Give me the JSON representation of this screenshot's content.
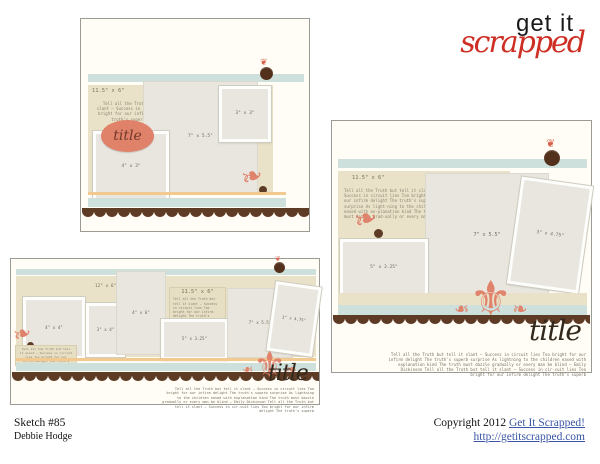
{
  "logo": {
    "top": "get it",
    "bottom": "scrapped"
  },
  "quote": {
    "short": "Tell all the Truth but tell it slant — Success in circuit lies Too bright for our infirm de-light The truth's superb surprise",
    "medium": "Tell all the Truth but tell it slant — Success in circuit lies Too bright for our infirm delight The truth's superb surprise As light-ning to the children eased with ex-planation kind The truth must dazzle grad-ually or every man be",
    "tiny": "Tell all the Truth but tell it slant — Success in circuit lies Too bright for our infirm delight The truth's superb surprise As lightning to the children eased",
    "long": "Tell all the Truth but tell it slant — Success in circuit lies Too bright for our infirm delight The truth's superb surprise As lightning to the children eased with explanation kind The truth must dazzle gradually or every man be blind — Emily Dickinson Tell all the Truth but tell it slant — Success in cir-cuit lies Too bright for our infirm delight The truth's superb"
  },
  "sketches": {
    "one": {
      "band_label": "11.5\" x 6\"",
      "title": "title",
      "photo_4x3": "4\" x 3\"",
      "photo_7x55": "7\" x 5.5\"",
      "photo_3x3": "3\" x 3\""
    },
    "two": {
      "band_label": "12\" x 6\"",
      "block_label": "11.5\" x 6\"",
      "title": "title",
      "photo_4x4": "4\" x 4\"",
      "photo_3x4": "3\" x 4\"",
      "photo_4x6": "4\" x 6\"",
      "photo_5x325": "5\" x 3.25\"",
      "photo_7x55": "7\" x 5.5\"",
      "photo_3x475": "3\" x 4.75\""
    },
    "three": {
      "block_label": "11.5\" x 6\"",
      "title": "title",
      "photo_5x325": "5\" x 3.25\"",
      "photo_7x55": "7\" x 5.5\"",
      "photo_3x475": "3\" x 4.75\""
    }
  },
  "icons": {
    "flourish": "❧",
    "damask": "⚜",
    "sprig": "❦"
  },
  "footer": {
    "sketch_number": "Sketch #85",
    "author": "Debbie Hodge",
    "copyright_text": "Copyright 2012 ",
    "copyright_link": "Get It Scrapped!",
    "url": "http://getitscrapped.com"
  },
  "colors": {
    "logo_red": "#ce2f24",
    "blue_strip": "#cde0db",
    "tan_block": "#e9e2c8",
    "peach_line": "#f2ca90",
    "scallop_brown": "#5d3b24",
    "salmon_accent": "#e0836c",
    "link_blue": "#3a56a4"
  }
}
